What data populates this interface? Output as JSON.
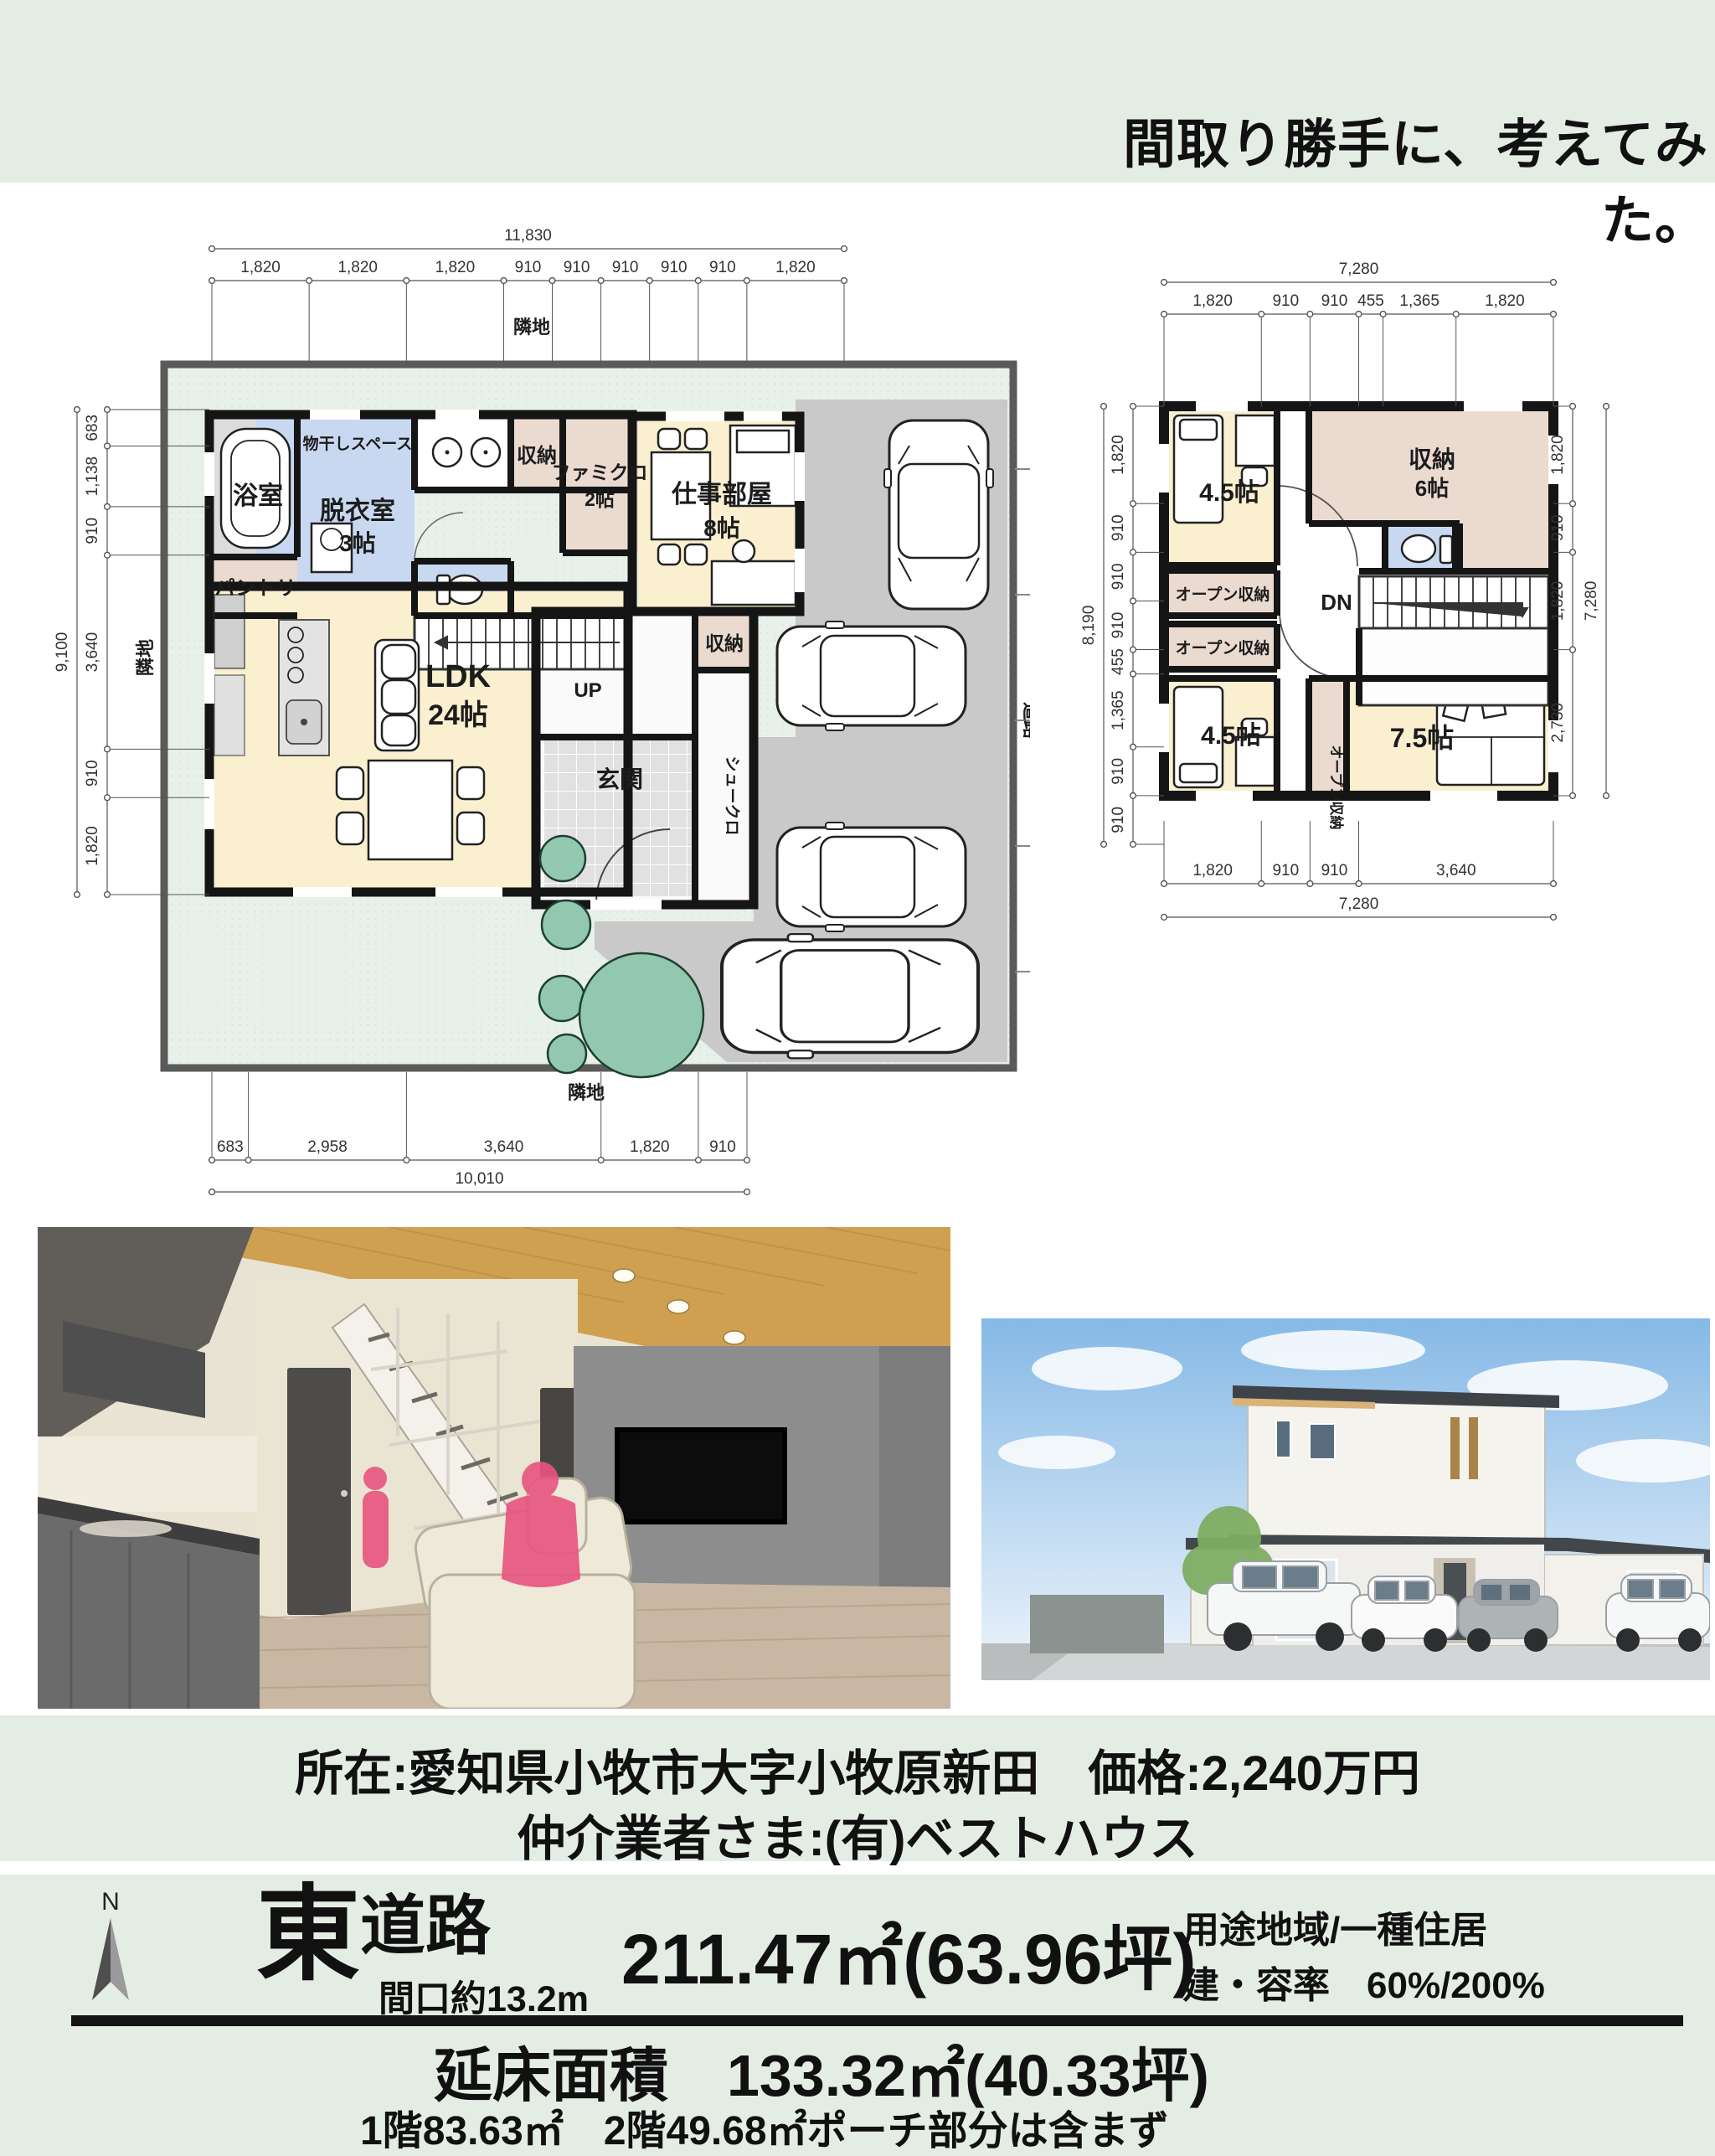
{
  "colors": {
    "bg": "#e4ede4",
    "panel": "#ffffff",
    "wall": "#151515",
    "cream": "#faf0cf",
    "blue": "#c9d8f1",
    "pink": "#eadad0",
    "gray_drive": "#c9c9c9",
    "porch": "#d4d4d4",
    "garden": "#e7f1ea",
    "tree": "#93c8b0",
    "dim": "#555555",
    "accent_pink_figure": "#e8537f",
    "sky": "#86b9e6",
    "wood_ceiling": "#cfa050"
  },
  "page": {
    "title": "間取り勝手に、考えてみた。"
  },
  "info": {
    "line1": "所在:愛知県小牧市大字小牧原新田　価格:2,240万円",
    "line2": "仲介業者さま:(有)ベストハウス"
  },
  "land": {
    "compass": "N",
    "direction": "東",
    "road": "道路",
    "frontage": "間口約13.2m",
    "area": "211.47㎡(63.96坪)",
    "zoning": "用途地域/一種住居",
    "coverage": "建・容率　60%/200%"
  },
  "totals": {
    "floor_area": "延床面積　133.32㎡(40.33坪)",
    "breakdown": "1階83.63㎡　2階49.68㎡ポーチ部分は含まず"
  },
  "plan1": {
    "labels": {
      "adjacent_top": "隣地",
      "adjacent_left": "隣地",
      "adjacent_bottom": "隣地",
      "road": "道路",
      "bath": "浴室",
      "drying": "物干しスペース",
      "dressing": "脱衣室",
      "dressing_size": "3帖",
      "storage": "収納",
      "famiclo": "ファミクロ",
      "famiclo_size": "2帖",
      "pantry": "パントリ",
      "work": "仕事部屋",
      "work_size": "8帖",
      "up": "UP",
      "ldk": "LDK",
      "ldk_size": "24帖",
      "entrance": "玄関",
      "shoe_closet": "シュークロ",
      "entrance_storage": "収納"
    },
    "dims": {
      "top": {
        "total": "11,830",
        "segments": [
          "1,820",
          "1,820",
          "1,820",
          "910",
          "910",
          "910",
          "910",
          "910",
          "1,820"
        ],
        "values": [
          1820,
          1820,
          1820,
          910,
          910,
          910,
          910,
          910,
          1820
        ]
      },
      "left": {
        "total": "9,100",
        "segments": [
          "683",
          "1,138",
          "910",
          "3,640",
          "910",
          "1,820"
        ],
        "values": [
          683,
          1138,
          910,
          3640,
          910,
          1820
        ]
      },
      "bottom": {
        "total": "10,010",
        "segments": [
          "683",
          "2,958",
          "3,640",
          "1,820",
          "910"
        ],
        "values": [
          683,
          2958,
          3640,
          1820,
          910
        ]
      }
    }
  },
  "plan2": {
    "labels": {
      "room1": "4.5帖",
      "storage": "収納",
      "storage_size": "6帖",
      "open1": "オープン収納",
      "open2": "オープン収納",
      "open3": "オープン収納",
      "dn": "DN",
      "room2": "4.5帖",
      "room3": "7.5帖"
    },
    "dims": {
      "top": {
        "total": "7,280",
        "segments": [
          "1,820",
          "910",
          "910",
          "455",
          "1,365",
          "1,820"
        ],
        "values": [
          1820,
          910,
          910,
          455,
          1365,
          1820
        ]
      },
      "left": {
        "total": "8,190",
        "segments": [
          "1,820",
          "910",
          "910",
          "910",
          "455",
          "1,365",
          "910",
          "910"
        ],
        "values": [
          1820,
          910,
          910,
          910,
          455,
          1365,
          910,
          910
        ]
      },
      "right": {
        "total": "7,280",
        "segments": [
          "1,820",
          "910",
          "1,820",
          "2,730"
        ],
        "values": [
          1820,
          910,
          1820,
          2730
        ]
      },
      "bottom": {
        "total": "7,280",
        "segments": [
          "1,820",
          "910",
          "910",
          "3,640"
        ],
        "values": [
          1820,
          910,
          910,
          3640
        ]
      }
    }
  }
}
